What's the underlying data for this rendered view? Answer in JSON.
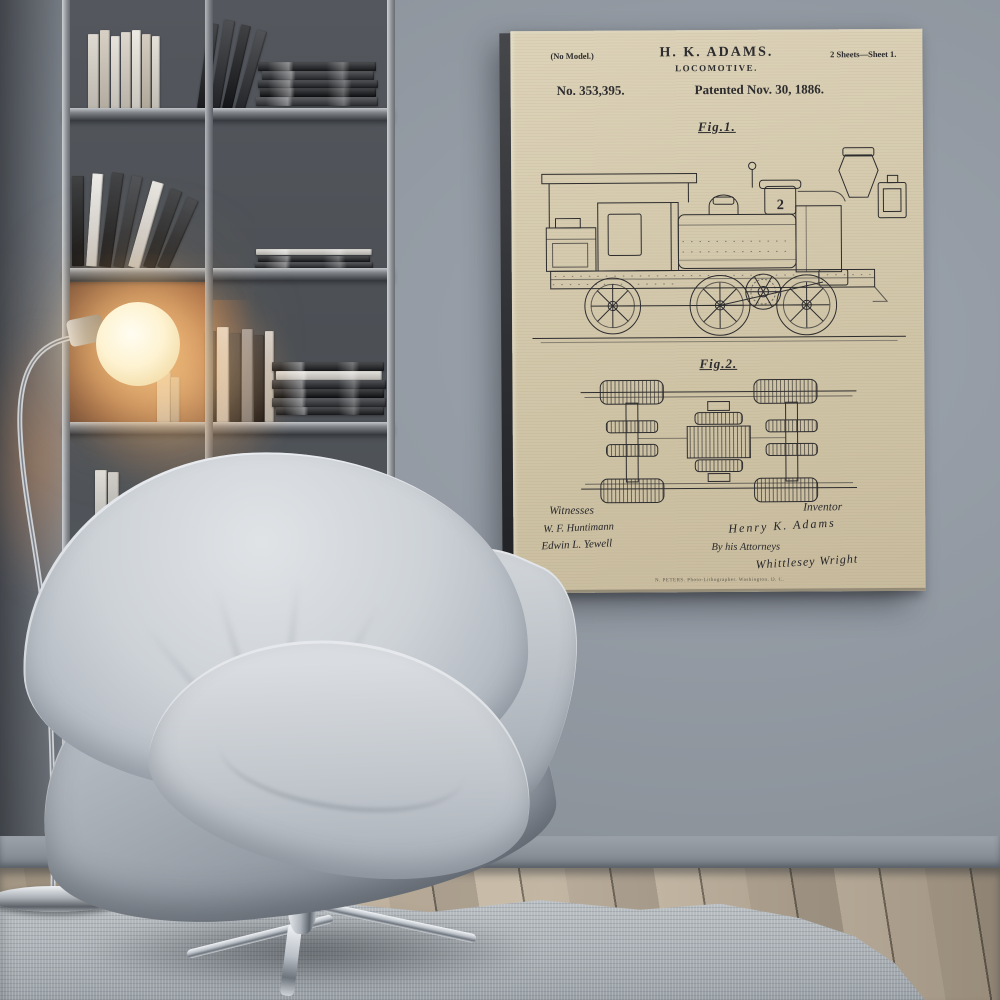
{
  "poster": {
    "annotation_left": "(No Model.)",
    "applicant": "H. K. ADAMS.",
    "invention_title": "LOCOMOTIVE.",
    "sheets_note": "2 Sheets—Sheet 1.",
    "patent_number": "No. 353,395.",
    "patent_date": "Patented Nov. 30, 1886.",
    "figure1_label": "Fig.1.",
    "figure2_label": "Fig.2.",
    "dome_numeral": "2",
    "witnesses_heading": "Witnesses",
    "witness_signature_1": "W. F. Huntimann",
    "witness_signature_2": "Edwin L. Yewell",
    "inventor_heading": "Inventor",
    "inventor_signature": "Henry K. Adams",
    "attorney_prefix": "By his Attorneys",
    "attorney_signature": "Whittlesey Wright",
    "printer_credit": "N. PETERS. Photo-Lithographer. Washington. D. C."
  },
  "scene": {
    "colors": {
      "wall": "#8d949c",
      "wall-light": "#9ca3ad",
      "wall-dark": "#5f646b",
      "paper-top": "#ddd3b9",
      "paper-bottom": "#c8bb9d",
      "ink": "#2d2c2e",
      "shelf-frame": "#a8adb2",
      "shelf-back": "#53575d",
      "lamp-glow": "#f5d7a0",
      "floor-light": "#bcae9a",
      "floor-dark": "#a49786",
      "rug": "#b2b8bc",
      "chair-light": "#e0e3e6",
      "chair-mid": "#b9bfc6",
      "chair-dark": "#868d96",
      "chrome": "#dfe3e7"
    }
  }
}
